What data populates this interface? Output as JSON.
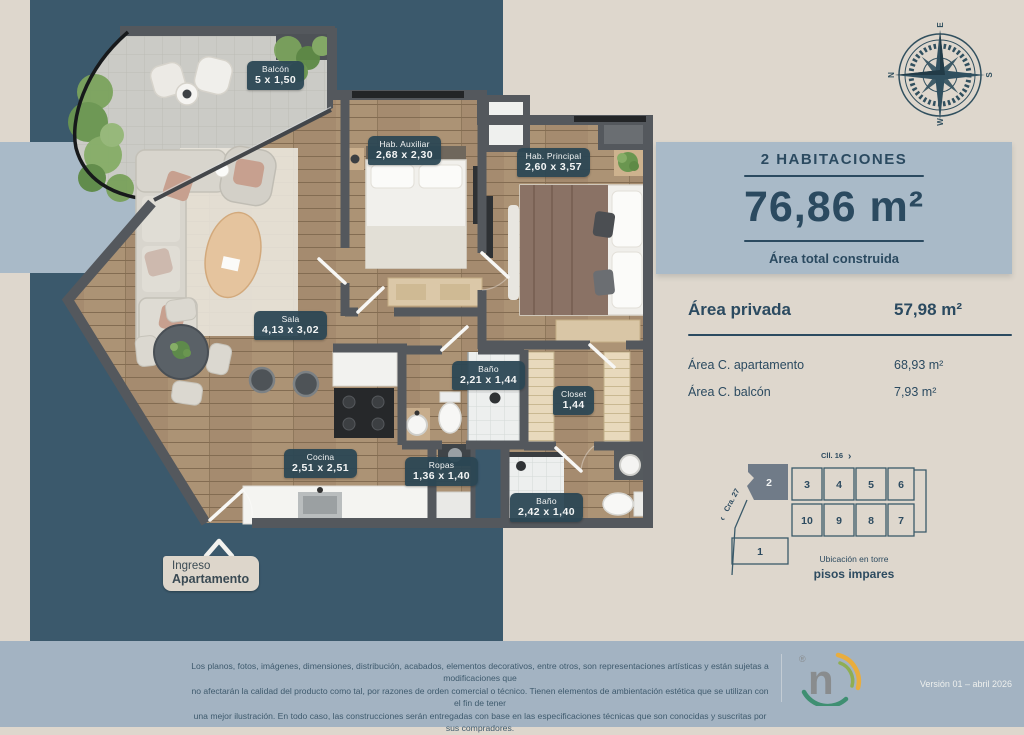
{
  "summary": {
    "bedrooms_label": "2 HABITACIONES",
    "total_area": "76,86 m²",
    "caption": "Área total construida"
  },
  "areas": {
    "private_label": "Área privada",
    "private_value": "57,98 m²",
    "rows": [
      {
        "label": "Área C. apartamento",
        "value": "68,93 m²"
      },
      {
        "label": "Área C. balcón",
        "value": "7,93 m²"
      }
    ]
  },
  "plan": {
    "rooms": [
      {
        "name": "Balcón",
        "dims": "5 x 1,50"
      },
      {
        "name": "Hab. Auxiliar",
        "dims": "2,68 x 2,30"
      },
      {
        "name": "Hab. Principal",
        "dims": "2,60 x 3,57"
      },
      {
        "name": "Sala",
        "dims": "4,13 x 3,02"
      },
      {
        "name": "Baño",
        "dims": "2,21 x 1,44"
      },
      {
        "name": "Closet",
        "dims": "1,44"
      },
      {
        "name": "Cocina",
        "dims": "2,51 x 2,51"
      },
      {
        "name": "Ropas",
        "dims": "1,36 x 1,40"
      },
      {
        "name": "Baño",
        "dims": "2,42 x 1,40"
      }
    ],
    "entrance": {
      "line1": "Ingreso",
      "line2": "Apartamento"
    }
  },
  "tower": {
    "street_top": "Cll. 16",
    "street_top_arrow": "›",
    "street_left_arrow": "‹",
    "street_left": "Cra. 27",
    "units_top": [
      "2",
      "3",
      "4",
      "5",
      "6"
    ],
    "units_bottom": [
      "10",
      "9",
      "8",
      "7"
    ],
    "unit_ground": "1",
    "highlighted_unit": "2",
    "caption_line1": "Ubicación en torre",
    "caption_line2": "pisos impares"
  },
  "compass": {
    "n": "N",
    "e": "E",
    "s": "S",
    "w": "W"
  },
  "footer": {
    "disclaimer_lines": [
      "Los planos, fotos, imágenes, dimensiones, distribución, acabados, elementos decorativos, entre otros, son representaciones artísticas y están sujetas a modificaciones que",
      "no afectarán la calidad del producto como tal, por razones de orden comercial o técnico. Tienen elementos de ambientación estética que se utilizan con el fin de tener",
      "una mejor ilustración. En todo caso, las construcciones serán entregadas con base en las especificaciones técnicas que son conocidas y suscritas por sus compradores."
    ],
    "version": "Versión 01 – abril 2026",
    "logo_letter": "n",
    "logo_reg": "®"
  },
  "colors": {
    "teal": "#3b596c",
    "band": "#a9bac8",
    "beige": "#ded7cd",
    "footer": "#a3b3c2",
    "text": "#2b4a60",
    "chip": "#2b4654",
    "wall": "#54585d"
  }
}
